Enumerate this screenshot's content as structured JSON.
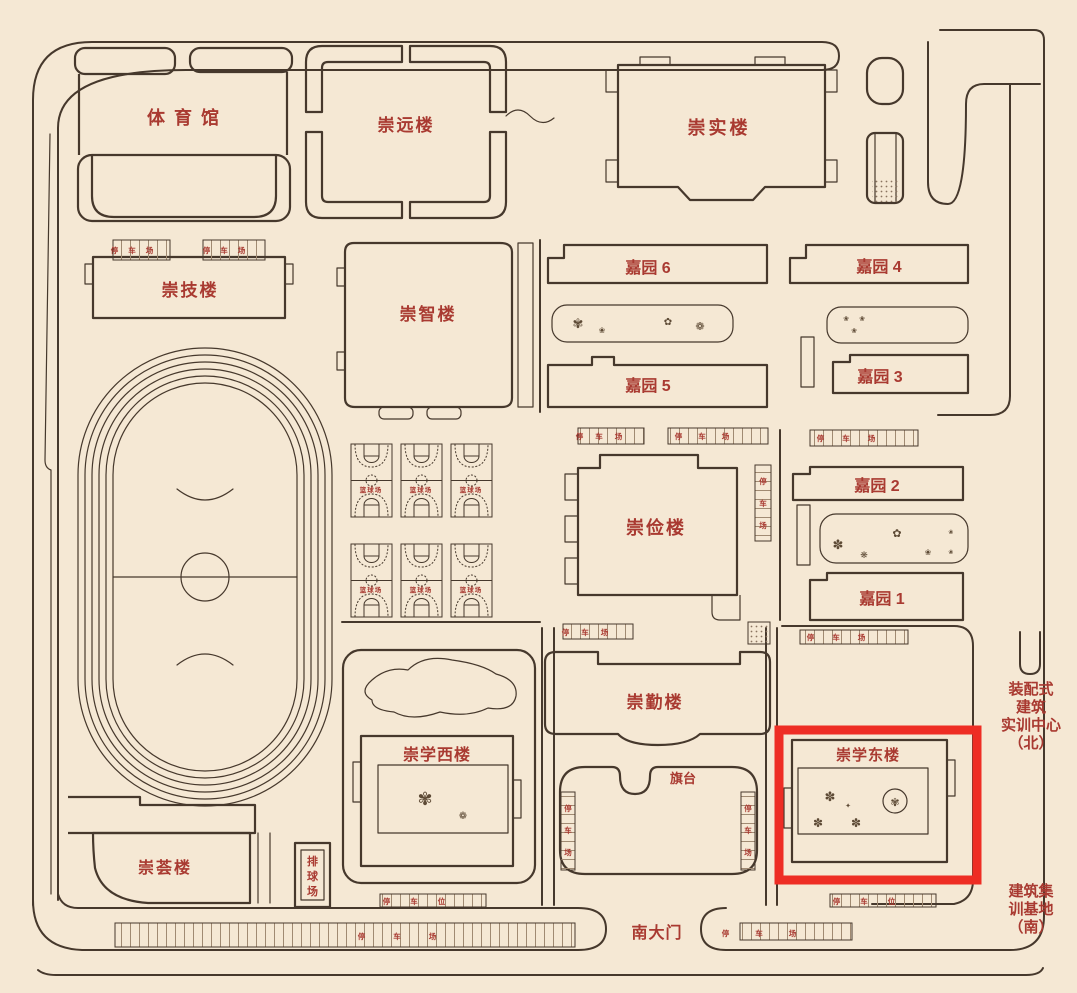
{
  "colors": {
    "bg": "#f5e8d4",
    "line": "#46382c",
    "red": "#a93a31",
    "highlight": "#ee2d24",
    "comb": "#a08a72",
    "plant": "#5d4a35"
  },
  "buildings": {
    "gym": "体 育 馆",
    "chongyuan": "崇远楼",
    "chongshi": "崇实楼",
    "chongji": "崇技楼",
    "chongzhi": "崇智楼",
    "chongjian": "崇俭楼",
    "chongqin": "崇勤楼",
    "chongxue_west": "崇学西楼",
    "chongxue_east": "崇学东楼",
    "chonghui": "崇荟楼",
    "jiayuan6": "嘉园 6",
    "jiayuan5": "嘉园 5",
    "jiayuan4": "嘉园 4",
    "jiayuan3": "嘉园 3",
    "jiayuan2": "嘉园 2",
    "jiayuan1": "嘉园 1"
  },
  "facilities": {
    "flag_platform": "旗台",
    "basketball_court": "篮球场",
    "volleyball_chars": [
      "排",
      "球",
      "场"
    ],
    "south_gate": "南大门",
    "parking_lot": "停车场",
    "parking_lot_chars": [
      "停",
      "车",
      "场"
    ],
    "parking_spot": "停车位"
  },
  "annotations": {
    "assembly_center_lines": [
      "装配式",
      "建筑",
      "实训中心",
      "（北）"
    ],
    "training_base_lines": [
      "建筑集",
      "训基地",
      "（南）"
    ]
  },
  "icons": {
    "plant_a": "✾",
    "plant_b": "✽",
    "flower_a": "❀",
    "flower_b": "✿",
    "flower_c": "❁",
    "asterisk": "❋",
    "sparkle": "✦"
  },
  "highlight": {
    "building": "崇学东楼"
  }
}
